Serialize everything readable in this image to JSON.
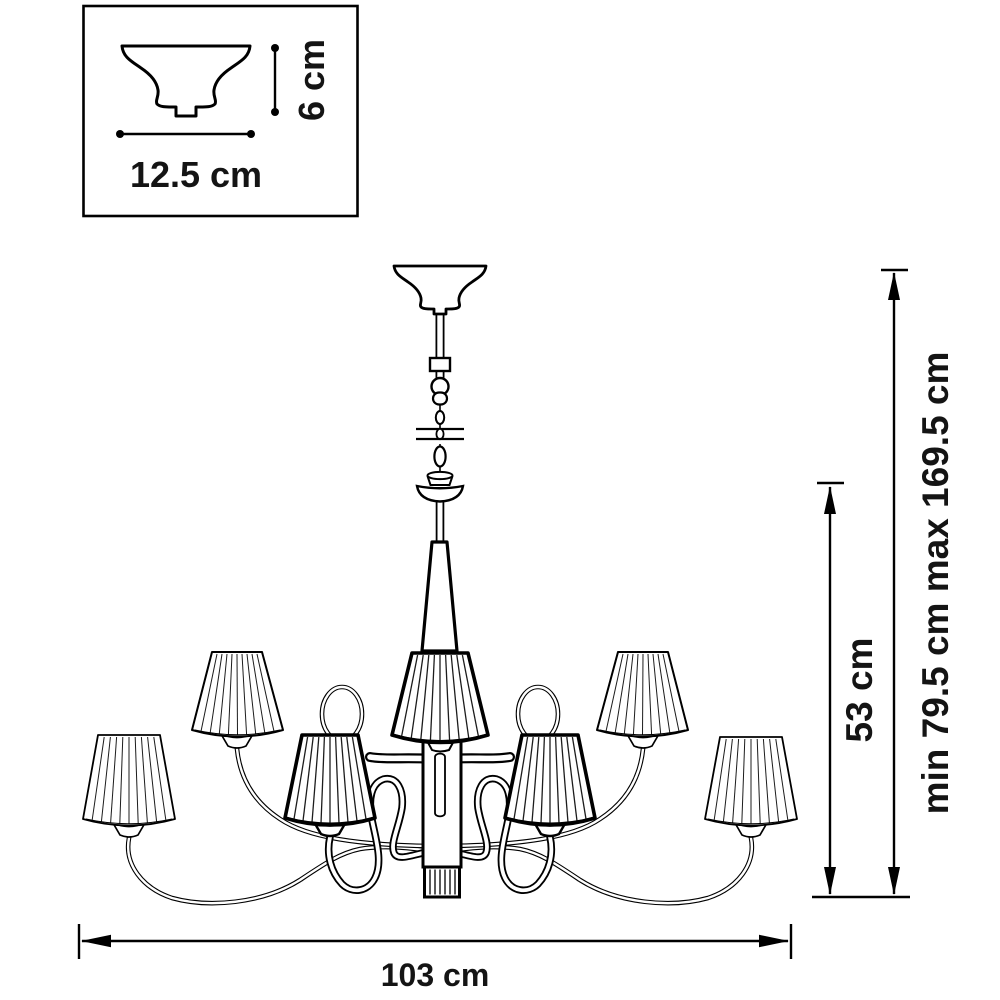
{
  "inset": {
    "height_label": "6 cm",
    "width_label": "12.5 cm"
  },
  "dimensions": {
    "width_label": "103 cm",
    "drop_height_label": "53 cm",
    "overall_height_label": "min 79.5 cm max 169.5 cm"
  },
  "colors": {
    "line": "#000000",
    "text": "#141414",
    "background": "#ffffff"
  }
}
